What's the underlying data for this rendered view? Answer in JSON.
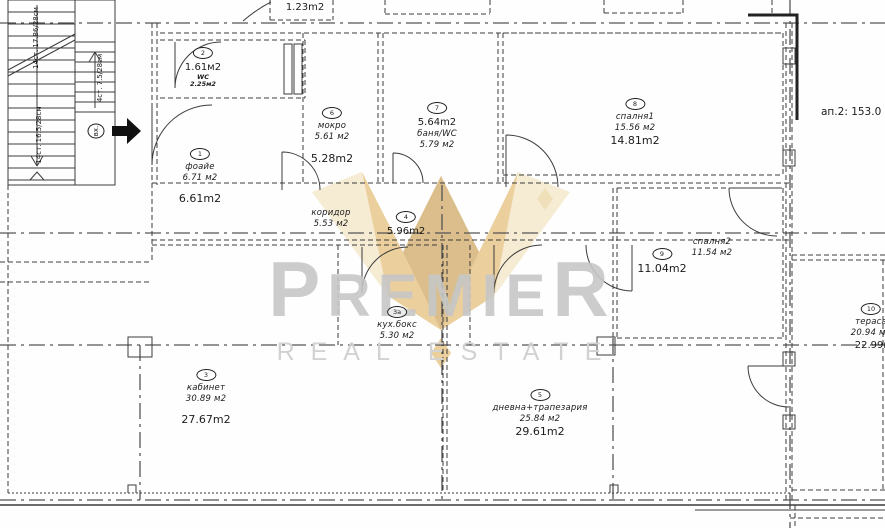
{
  "plan": {
    "apartment_note": "ап.2: 153.0",
    "top_room_area": "1.23m2",
    "corridor": {
      "name": "коридор",
      "area_design": "5.53 м2"
    },
    "stairs": {
      "flight_a": "14ст. 17.86/28см",
      "flight_b": "4ст. 7.5/28см",
      "flight_c": "14ст. 16.5/28см",
      "entrance": "вх."
    },
    "rooms": {
      "foyer": {
        "num": "1",
        "name": "фоайе",
        "area_design": "6.71 м2",
        "area_built": "6.61m2"
      },
      "wc": {
        "num": "2",
        "area_design": "1.61м2",
        "sub_name": "WC",
        "sub_area": "2.25м2"
      },
      "kabinet": {
        "num": "3",
        "name": "кабинет",
        "area_design": "30.89 м2",
        "area_built": "27.67m2"
      },
      "kitchen": {
        "num": "3а",
        "name": "кух.бокс",
        "area_design": "5.30 м2"
      },
      "hall": {
        "num": "4",
        "area_built": "5.96m2"
      },
      "living": {
        "num": "5",
        "name": "дневна+трапезария",
        "area_design": "25.84 м2",
        "area_built": "29.61m2"
      },
      "mokro": {
        "num": "6",
        "name": "мокро",
        "area_design": "5.61 м2",
        "area_built": "5.28m2"
      },
      "bath": {
        "num": "7",
        "area_built": "5.64m2",
        "name": "баня/WC",
        "area_design": "5.79 м2"
      },
      "bedroom1": {
        "num": "8",
        "name": "спалня1",
        "area_design": "15.56 м2",
        "area_built": "14.81m2"
      },
      "bedroom2": {
        "num": "9",
        "area_built": "11.04m2",
        "name": "спалня2",
        "area_design": "11.54 м2"
      },
      "terrace": {
        "num": "10",
        "name": "тераса",
        "area_design": "20.94 м2",
        "area_built": "22.99м2"
      }
    },
    "watermark": {
      "brand": "PREMIER",
      "tagline": "REAL ESTATE",
      "gold": "#dcaa4e",
      "gray": "#c7c7c7"
    }
  }
}
